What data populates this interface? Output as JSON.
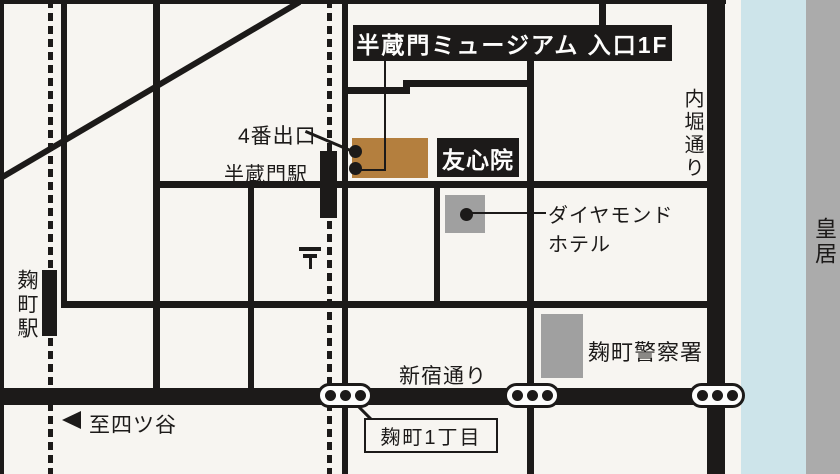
{
  "map": {
    "title": "半蔵門ミュージアム 入口1F",
    "stations": {
      "hanzomon": "半蔵門駅",
      "hanzomon_exit4": "4番出口",
      "kojimachi": "麹町駅"
    },
    "landmarks": {
      "yushinin": "友心院",
      "diamond_hotel_line1": "ダイヤモンド",
      "diamond_hotel_line2": "ホテル",
      "kojimachi_police": "麹町警察署",
      "imperial_palace": "皇居"
    },
    "roads": {
      "uchibori_dori": "内堀通り",
      "shinjuku_dori": "新宿通り"
    },
    "annotations": {
      "to_yotsuya": "至四ツ谷",
      "kojimachi_1chome": "麹町1丁目"
    },
    "icons": {
      "postal_mark": "〒",
      "west_arrow": "◀"
    },
    "colors": {
      "background": "#f7f5f1",
      "road_black": "#1c1a19",
      "museum_building_brown": "#b47f3e",
      "landmark_gray": "#a0a0a0",
      "moat_blue": "#cde4ea",
      "palace_band_gray": "#ababab"
    }
  }
}
